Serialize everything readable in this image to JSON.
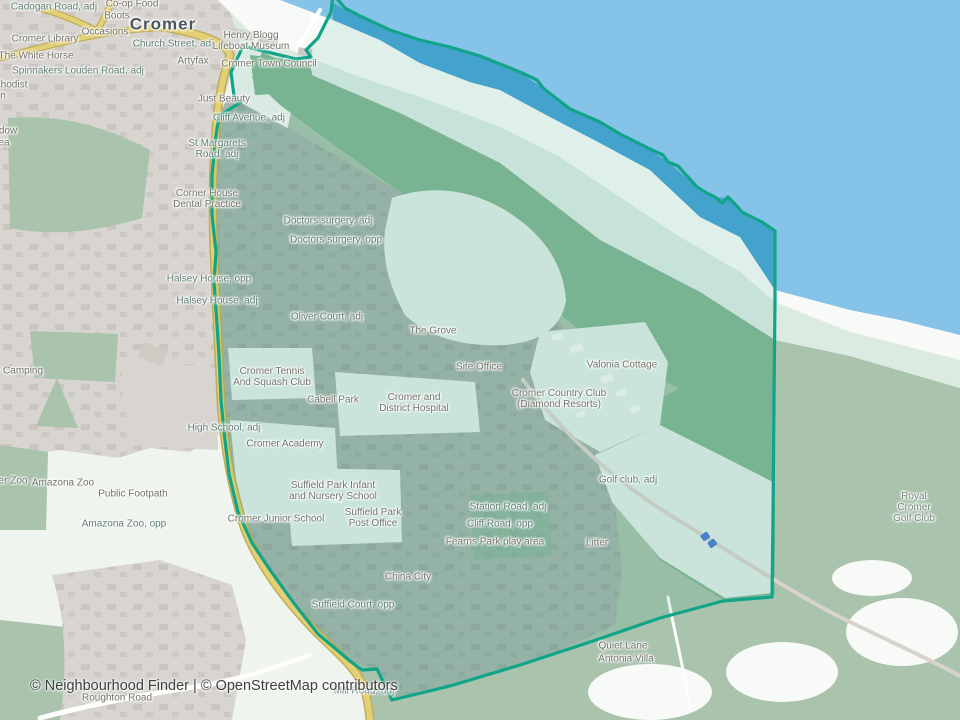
{
  "map": {
    "region_name": "Cromer neighbourhood boundary",
    "labels": [
      {
        "t": "Cromer",
        "x": 163,
        "y": 24,
        "k": "c"
      },
      {
        "t": "Co-op Food",
        "x": 132,
        "y": 4,
        "k": "n"
      },
      {
        "t": "Cadogan Road, adj",
        "x": 54,
        "y": 7,
        "k": "s"
      },
      {
        "t": "Boots",
        "x": 117,
        "y": 16,
        "k": "n"
      },
      {
        "t": "Occasions",
        "x": 105,
        "y": 32,
        "k": "n"
      },
      {
        "t": "Cromer Library",
        "x": 45,
        "y": 39,
        "k": "n"
      },
      {
        "t": "Church Street, adj",
        "x": 173,
        "y": 44,
        "k": "s"
      },
      {
        "t": "The White Horse",
        "x": 36,
        "y": 56,
        "k": "n"
      },
      {
        "t": "Artyfax",
        "x": 193,
        "y": 61,
        "k": "n"
      },
      {
        "t": "Henry Blogg\nLifeboat Museum",
        "x": 251,
        "y": 41,
        "k": "n"
      },
      {
        "t": "Cromer Town Council",
        "x": 269,
        "y": 64,
        "k": "n"
      },
      {
        "t": "Spinnakers Louden Road, adj",
        "x": 78,
        "y": 71,
        "k": "s"
      },
      {
        "t": "hodist",
        "x": 14,
        "y": 85,
        "k": "n"
      },
      {
        "t": "n",
        "x": 3,
        "y": 96,
        "k": "n"
      },
      {
        "t": "Just Beauty",
        "x": 224,
        "y": 99,
        "k": "n"
      },
      {
        "t": "Cliff Avenue, adj",
        "x": 249,
        "y": 118,
        "k": "s"
      },
      {
        "t": "dow",
        "x": 8,
        "y": 131,
        "k": "n"
      },
      {
        "t": "ea",
        "x": 4,
        "y": 143,
        "k": "n"
      },
      {
        "t": "St Margarets\nRoad, adj",
        "x": 217,
        "y": 149,
        "k": "s"
      },
      {
        "t": "Corner House\nDental Practice",
        "x": 207,
        "y": 199,
        "k": "n"
      },
      {
        "t": "Doctors surgery, adj",
        "x": 328,
        "y": 221,
        "k": "s"
      },
      {
        "t": "Doctors surgery, opp",
        "x": 336,
        "y": 240,
        "k": "s"
      },
      {
        "t": "Halsey House, opp",
        "x": 209,
        "y": 279,
        "k": "s"
      },
      {
        "t": "Halsey House, adj",
        "x": 217,
        "y": 301,
        "k": "s"
      },
      {
        "t": "Oliver Court, adj",
        "x": 327,
        "y": 317,
        "k": "s"
      },
      {
        "t": "The Grove",
        "x": 433,
        "y": 331,
        "k": "n"
      },
      {
        "t": "Site Office",
        "x": 479,
        "y": 367,
        "k": "n"
      },
      {
        "t": "Valonia Cottage",
        "x": 622,
        "y": 365,
        "k": "n"
      },
      {
        "t": "Cromer Tennis\nAnd Squash Club",
        "x": 272,
        "y": 377,
        "k": "n"
      },
      {
        "t": "r Camping",
        "x": 20,
        "y": 371,
        "k": "n"
      },
      {
        "t": "Cabell Park",
        "x": 333,
        "y": 400,
        "k": "n"
      },
      {
        "t": "Cromer and\nDistrict Hospital",
        "x": 414,
        "y": 403,
        "k": "n"
      },
      {
        "t": "Cromer Country Club\n(Diamond Resorts)",
        "x": 559,
        "y": 399,
        "k": "n"
      },
      {
        "t": "High School, adj",
        "x": 224,
        "y": 428,
        "k": "s"
      },
      {
        "t": "Cromer Academy",
        "x": 285,
        "y": 444,
        "k": "n"
      },
      {
        "t": "Golf club, adj",
        "x": 628,
        "y": 480,
        "k": "s"
      },
      {
        "t": "er Zoo",
        "x": 13,
        "y": 481,
        "k": "n"
      },
      {
        "t": "Amazona Zoo",
        "x": 63,
        "y": 483,
        "k": "n"
      },
      {
        "t": "Public Footpath",
        "x": 133,
        "y": 494,
        "k": "n"
      },
      {
        "t": "Suffield Park Infant\nand Nursery School",
        "x": 333,
        "y": 491,
        "k": "n"
      },
      {
        "t": "Station Road, adj",
        "x": 508,
        "y": 507,
        "k": "s"
      },
      {
        "t": "Royal Cromer\nGolf Club",
        "x": 914,
        "y": 508,
        "k": "a"
      },
      {
        "t": "Suffield Park\nPost Office",
        "x": 373,
        "y": 518,
        "k": "n"
      },
      {
        "t": "Cromer Junior School",
        "x": 276,
        "y": 519,
        "k": "n"
      },
      {
        "t": "Amazona Zoo, opp",
        "x": 124,
        "y": 524,
        "k": "s"
      },
      {
        "t": "Cliff Road, opp",
        "x": 500,
        "y": 524,
        "k": "s"
      },
      {
        "t": "Fearns Park play area",
        "x": 495,
        "y": 542,
        "k": "n"
      },
      {
        "t": "Litter",
        "x": 597,
        "y": 543,
        "k": "n"
      },
      {
        "t": "China City",
        "x": 408,
        "y": 577,
        "k": "n"
      },
      {
        "t": "Suffield Court, opp",
        "x": 353,
        "y": 605,
        "k": "s"
      },
      {
        "t": "Quiet Lane",
        "x": 623,
        "y": 646,
        "k": "n"
      },
      {
        "t": "Antonia Villa",
        "x": 626,
        "y": 659,
        "k": "n"
      },
      {
        "t": "Mill Road, adj",
        "x": 364,
        "y": 691,
        "k": "s"
      },
      {
        "t": "Roughton Road",
        "x": 117,
        "y": 698,
        "k": "n"
      }
    ]
  },
  "attribution": {
    "prefix": "© ",
    "brand": "Neighbourhood Finder",
    "separator": " | © ",
    "osm": "OpenStreetMap contributors"
  },
  "colors": {
    "base": "#f0f4ee",
    "sea": "#86c3e9",
    "sea_inner": "#49a5d6",
    "beach": "#f7faf6",
    "cliff": "#dcebe2",
    "green": "#a9c3ad",
    "green_dark": "#84b795",
    "urban": "#d8d4cf",
    "town": "#a4b6ab",
    "pale": "#dfeee6",
    "road": "#e3cf74",
    "road_casing": "#c0ad5c",
    "white_road": "#fdfdfb",
    "boundary": "#12a488",
    "parking": "#4d7fd6"
  }
}
